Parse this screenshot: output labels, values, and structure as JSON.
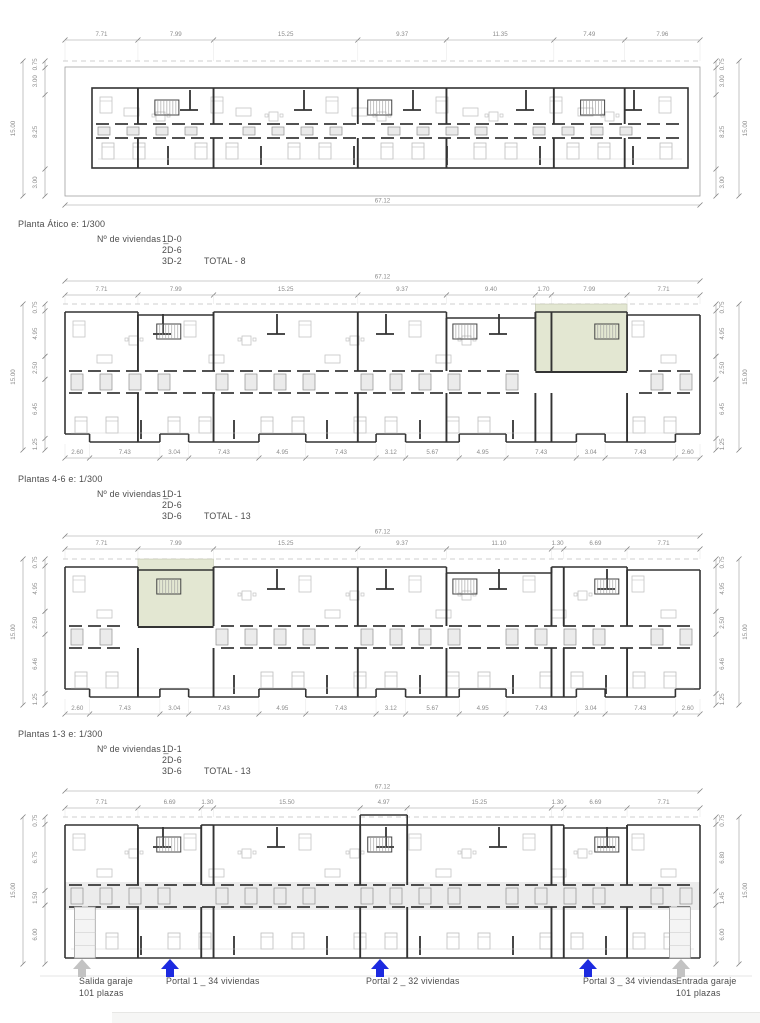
{
  "sheet": {
    "kind": "architectural floor plans",
    "scale_note": "e: 1/300"
  },
  "colors": {
    "wall": "#333333",
    "furniture": "#c4c4c4",
    "dim_line": "#9b9b9b",
    "dim_text": "#8c8c8c",
    "caption_text": "#4c4c4c",
    "patio_fill": "#e3e7d2",
    "portal_arrow": "#1c2ae0",
    "garage_arrow": "#c3c3c3"
  },
  "plans": [
    {
      "id": "planta-atico",
      "title": "Planta Ático e: 1/300",
      "viviendas_prefix": "Nº de viviendas _",
      "unit_counts": [
        "1D-0",
        "2D-6",
        "3D-2"
      ],
      "total": "TOTAL - 8",
      "overall_width": "67.12",
      "top_dims": [
        "7.71",
        "7.99",
        "15.25",
        "9.37",
        "11.35",
        "7.49",
        "7.96"
      ],
      "left_overall": "15.00",
      "left_dims": [
        "0.75",
        "3.00",
        "8.25",
        "3.00"
      ],
      "right_overall": "15.00",
      "right_dims": [
        "0.75",
        "3.00",
        "8.25",
        "3.00"
      ],
      "bottom_dims": []
    },
    {
      "id": "plantas-4-6",
      "title": "Plantas 4-6 e: 1/300",
      "viviendas_prefix": "Nº de viviendas _",
      "unit_counts": [
        "1D-1",
        "2D-6",
        "3D-6"
      ],
      "total": "TOTAL - 13",
      "overall_width": "67.12",
      "top_dims": [
        "7.71",
        "7.99",
        "15.25",
        "9.37",
        "9.40",
        "1.70",
        "7.99",
        "7.71"
      ],
      "left_overall": "15.00",
      "left_dims": [
        "0.75",
        "4.95",
        "2.50",
        "6.45",
        "1.25"
      ],
      "right_overall": "15.00",
      "right_dims": [
        "0.75",
        "4.95",
        "2.50",
        "6.45",
        "1.25"
      ],
      "bottom_dims": [
        "2.60",
        "7.43",
        "3.04",
        "7.43",
        "4.95",
        "7.43",
        "3.12",
        "5.67",
        "4.95",
        "7.43",
        "3.04",
        "7.43",
        "2.60"
      ]
    },
    {
      "id": "plantas-1-3",
      "title": "Plantas 1-3 e: 1/300",
      "viviendas_prefix": "Nº de viviendas _",
      "unit_counts": [
        "1D-1",
        "2D-6",
        "3D-6"
      ],
      "total": "TOTAL - 13",
      "overall_width": "67.12",
      "top_dims": [
        "7.71",
        "7.99",
        "15.25",
        "9.37",
        "11.10",
        "1.30",
        "6.69",
        "7.71"
      ],
      "left_overall": "15.00",
      "left_dims": [
        "0.75",
        "4.95",
        "2.50",
        "6.46",
        "1.25"
      ],
      "right_overall": "15.00",
      "right_dims": [
        "0.75",
        "4.95",
        "2.50",
        "6.46",
        "1.25"
      ],
      "bottom_dims": [
        "2.60",
        "7.43",
        "3.04",
        "7.43",
        "4.95",
        "7.43",
        "3.12",
        "5.67",
        "4.95",
        "7.43",
        "3.04",
        "7.43",
        "2.60"
      ]
    },
    {
      "id": "planta-baja",
      "overall_width": "67.12",
      "top_dims": [
        "7.71",
        "6.69",
        "1.30",
        "15.50",
        "4.97",
        "15.25",
        "1.30",
        "6.69",
        "7.71"
      ],
      "left_overall": "15.00",
      "left_dims": [
        "0.75",
        "6.75",
        "1.50",
        "6.00"
      ],
      "right_overall": "15.00",
      "right_dims": [
        "0.75",
        "6.80",
        "1.45",
        "6.00"
      ],
      "bottom_dims": []
    }
  ],
  "entrances": [
    {
      "kind": "garage",
      "label": "Salida garaje",
      "sublabel": "101 plazas"
    },
    {
      "kind": "portal",
      "label": "Portal 1 _ 34 viviendas"
    },
    {
      "kind": "portal",
      "label": "Portal 2 _ 32 viviendas"
    },
    {
      "kind": "portal",
      "label": "Portal 3 _ 34 viviendas"
    },
    {
      "kind": "garage",
      "label": "Entrada garaje",
      "sublabel": "101 plazas"
    }
  ]
}
